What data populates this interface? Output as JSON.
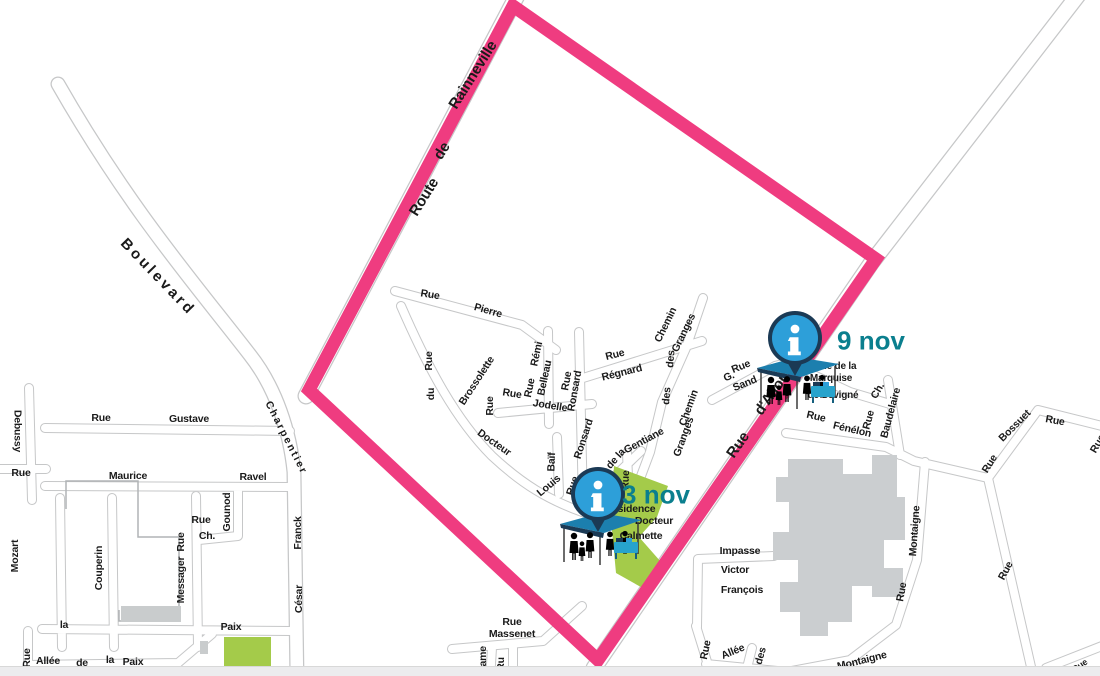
{
  "map": {
    "colors": {
      "pink": "#EF3C80",
      "teal": "#0B7F8E",
      "blue": "#2D9FD9",
      "navy": "#1B3A55",
      "tent": "#1C7FAE",
      "table": "#27A3CC",
      "road": "#C6C7C8",
      "building": "#CBCED0",
      "building-outline": "#B0B4B6",
      "green": "#A4CB4A",
      "ink": "#1A1A1A",
      "strip": "#ECECEE"
    },
    "boundary": {
      "name": "event perimeter",
      "points": "513,6 876,259 598,660 309,390"
    },
    "events": [
      {
        "label": "3 nov",
        "anchor": {
          "x": 598,
          "y": 494
        },
        "label_offset": {
          "x": 118,
          "y": 33
        }
      },
      {
        "label": "9 nov",
        "anchor": {
          "x": 795,
          "y": 338
        },
        "label_offset": {
          "x": 136,
          "y": 35
        }
      }
    ],
    "street_labels": [
      {
        "t": "Route",
        "x": 424,
        "y": 197,
        "r": -58,
        "s": 15
      },
      {
        "t": "de",
        "x": 442,
        "y": 151,
        "r": -58,
        "s": 15
      },
      {
        "t": "Rainneville",
        "x": 473,
        "y": 75,
        "r": -58,
        "s": 15
      },
      {
        "t": "Rue",
        "x": 738,
        "y": 445,
        "r": -55,
        "s": 15
      },
      {
        "t": "d'Allonville",
        "x": 780,
        "y": 382,
        "r": -55,
        "s": 15
      },
      {
        "t": "Boulevard",
        "x": 158,
        "y": 277,
        "r": 46,
        "s": 15,
        "ls": 3
      },
      {
        "t": "Debussy",
        "x": 17,
        "y": 431,
        "r": 90
      },
      {
        "t": "Rue",
        "x": 21,
        "y": 473,
        "r": 0
      },
      {
        "t": "Rue",
        "x": 101,
        "y": 418,
        "r": 0
      },
      {
        "t": "Gustave",
        "x": 189,
        "y": 419,
        "r": 0
      },
      {
        "t": "Charpentier",
        "x": 286,
        "y": 438,
        "r": 63,
        "ls": 2
      },
      {
        "t": "Maurice",
        "x": 128,
        "y": 476,
        "r": 0
      },
      {
        "t": "Ravel",
        "x": 253,
        "y": 477,
        "r": 0
      },
      {
        "t": "Rue",
        "x": 201,
        "y": 520,
        "r": 0
      },
      {
        "t": "Ch.",
        "x": 207,
        "y": 536,
        "r": 0
      },
      {
        "t": "Gounod",
        "x": 227,
        "y": 512,
        "r": -90
      },
      {
        "t": "Mozart",
        "x": 15,
        "y": 556,
        "r": -90
      },
      {
        "t": "Couperin",
        "x": 99,
        "y": 568,
        "r": -90
      },
      {
        "t": "Rue",
        "x": 181,
        "y": 542,
        "r": -90
      },
      {
        "t": "Messager",
        "x": 181,
        "y": 580,
        "r": -90
      },
      {
        "t": "Franck",
        "x": 298,
        "y": 533,
        "r": -90
      },
      {
        "t": "César",
        "x": 299,
        "y": 599,
        "r": -90
      },
      {
        "t": "la",
        "x": 64,
        "y": 625,
        "r": 0
      },
      {
        "t": "Paix",
        "x": 231,
        "y": 627,
        "r": 0
      },
      {
        "t": "Rue",
        "x": 27,
        "y": 658,
        "r": -90
      },
      {
        "t": "Allée",
        "x": 48,
        "y": 661,
        "r": 0
      },
      {
        "t": "de",
        "x": 82,
        "y": 663,
        "r": 0
      },
      {
        "t": "la",
        "x": 110,
        "y": 660,
        "r": 0
      },
      {
        "t": "Paix",
        "x": 133,
        "y": 662,
        "r": 0
      },
      {
        "t": "Rue",
        "x": 430,
        "y": 295,
        "r": 9
      },
      {
        "t": "Pierre",
        "x": 488,
        "y": 311,
        "r": 16
      },
      {
        "t": "Rue",
        "x": 429,
        "y": 361,
        "r": -90
      },
      {
        "t": "du",
        "x": 431,
        "y": 394,
        "r": -90
      },
      {
        "t": "Brossolette",
        "x": 477,
        "y": 381,
        "r": -57
      },
      {
        "t": "Docteur",
        "x": 494,
        "y": 443,
        "r": 35
      },
      {
        "t": "Rue",
        "x": 512,
        "y": 394,
        "r": 9
      },
      {
        "t": "Jodelle",
        "x": 550,
        "y": 406,
        "r": 9
      },
      {
        "t": "Rue",
        "x": 490,
        "y": 406,
        "r": -90
      },
      {
        "t": "Rémi",
        "x": 537,
        "y": 354,
        "r": -78
      },
      {
        "t": "Belleau",
        "x": 545,
        "y": 378,
        "r": -78
      },
      {
        "t": "Rue",
        "x": 530,
        "y": 388,
        "r": -78
      },
      {
        "t": "Rue",
        "x": 567,
        "y": 381,
        "r": -80
      },
      {
        "t": "Ronsard",
        "x": 575,
        "y": 391,
        "r": -80
      },
      {
        "t": "Ronsard",
        "x": 584,
        "y": 439,
        "r": -72
      },
      {
        "t": "Rue",
        "x": 573,
        "y": 486,
        "r": -72
      },
      {
        "t": "Baïf",
        "x": 552,
        "y": 462,
        "r": -88
      },
      {
        "t": "Louis",
        "x": 549,
        "y": 486,
        "r": -40
      },
      {
        "t": "Rue",
        "x": 615,
        "y": 355,
        "r": -14
      },
      {
        "t": "Régnard",
        "x": 622,
        "y": 373,
        "r": -14
      },
      {
        "t": "Chemin",
        "x": 666,
        "y": 325,
        "r": -64
      },
      {
        "t": "des",
        "x": 671,
        "y": 359,
        "r": -85
      },
      {
        "t": "Granges",
        "x": 684,
        "y": 333,
        "r": -64
      },
      {
        "t": "des",
        "x": 667,
        "y": 396,
        "r": -85
      },
      {
        "t": "Chemin",
        "x": 689,
        "y": 408,
        "r": -70
      },
      {
        "t": "Granges",
        "x": 684,
        "y": 437,
        "r": -70
      },
      {
        "t": "Gentiane",
        "x": 644,
        "y": 441,
        "r": -28
      },
      {
        "t": "de la",
        "x": 616,
        "y": 459,
        "r": -48
      },
      {
        "t": "Rue",
        "x": 626,
        "y": 480,
        "r": -88
      },
      {
        "t": "Rue",
        "x": 741,
        "y": 367,
        "r": -22
      },
      {
        "t": "G.",
        "x": 729,
        "y": 377,
        "r": -22
      },
      {
        "t": "Sand",
        "x": 745,
        "y": 384,
        "r": -22
      },
      {
        "t": "Rue  de  la",
        "x": 835,
        "y": 367,
        "r": 0,
        "s": 10
      },
      {
        "t": "Marquise",
        "x": 831,
        "y": 379,
        "r": 0,
        "s": 10
      },
      {
        "t": "de  Sévigné",
        "x": 833,
        "y": 396,
        "r": 0,
        "s": 10
      },
      {
        "t": "Rue",
        "x": 816,
        "y": 417,
        "r": 13
      },
      {
        "t": "Fénélon",
        "x": 852,
        "y": 430,
        "r": 13
      },
      {
        "t": "Rue",
        "x": 869,
        "y": 420,
        "r": -75
      },
      {
        "t": "Ch.",
        "x": 878,
        "y": 391,
        "r": -60
      },
      {
        "t": "Baudelaire",
        "x": 891,
        "y": 413,
        "r": -75
      },
      {
        "t": "Rue",
        "x": 990,
        "y": 464,
        "r": -58
      },
      {
        "t": "Bossuet",
        "x": 1015,
        "y": 426,
        "r": -45
      },
      {
        "t": "Rue",
        "x": 1055,
        "y": 421,
        "r": 10
      },
      {
        "t": "Rue",
        "x": 1098,
        "y": 444,
        "r": -60
      },
      {
        "t": "Montaigne",
        "x": 915,
        "y": 531,
        "r": -86
      },
      {
        "t": "Rue",
        "x": 902,
        "y": 592,
        "r": -80
      },
      {
        "t": "Rue",
        "x": 1006,
        "y": 571,
        "r": -62
      },
      {
        "t": "Impasse",
        "x": 740,
        "y": 551,
        "r": 0
      },
      {
        "t": "Victor",
        "x": 735,
        "y": 570,
        "r": 0
      },
      {
        "t": "François",
        "x": 742,
        "y": 590,
        "r": 0
      },
      {
        "t": "Rue",
        "x": 512,
        "y": 622,
        "r": 0
      },
      {
        "t": "Massenet",
        "x": 512,
        "y": 634,
        "r": 0
      },
      {
        "t": "Rame",
        "x": 483,
        "y": 660,
        "r": -90
      },
      {
        "t": "Ru",
        "x": 501,
        "y": 664,
        "r": -90
      },
      {
        "t": "Rue",
        "x": 706,
        "y": 650,
        "r": -78
      },
      {
        "t": "Allée",
        "x": 733,
        "y": 652,
        "r": -22
      },
      {
        "t": "des",
        "x": 761,
        "y": 656,
        "r": -75
      },
      {
        "t": "Montaigne",
        "x": 862,
        "y": 661,
        "r": -14
      },
      {
        "t": "Rue",
        "x": 1080,
        "y": 666,
        "r": -35,
        "s": 9
      },
      {
        "t": "Résidence",
        "x": 630,
        "y": 509,
        "r": 0
      },
      {
        "t": "Docteur",
        "x": 654,
        "y": 521,
        "r": 0
      },
      {
        "t": "Calmette",
        "x": 641,
        "y": 536,
        "r": 0
      }
    ]
  }
}
